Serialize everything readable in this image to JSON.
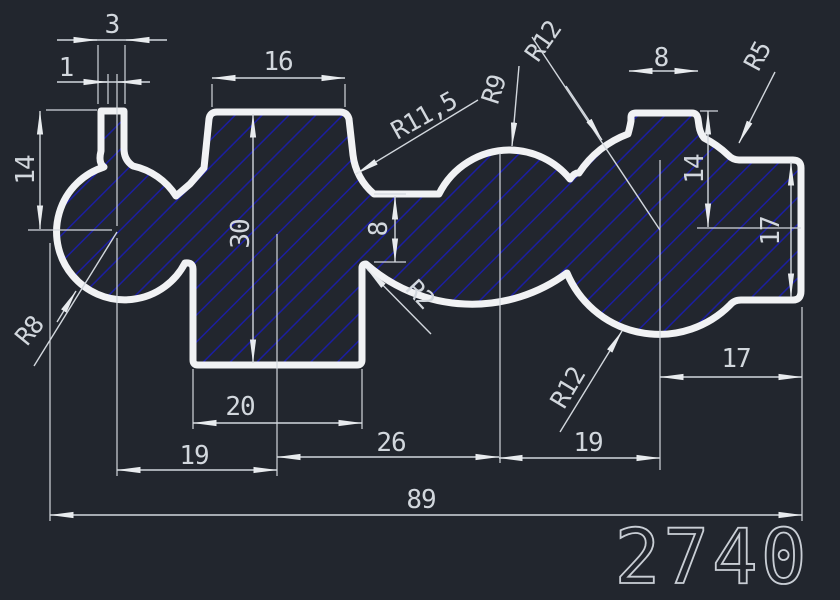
{
  "drawing": {
    "type": "cad-profile-drawing",
    "part_number": "2740",
    "colors": {
      "background": "#22262e",
      "hatch_blue": "#1b1ea0",
      "outline_white": "#f1f2f4",
      "dimension_gray": "#d2d7dd"
    },
    "dims": {
      "d3": "3",
      "d1": "1",
      "d16": "16",
      "d8_top": "8",
      "d14_left": "14",
      "d30": "30",
      "d8_mid": "8",
      "d14_right": "14",
      "d17_right": "17",
      "d20": "20",
      "d19_left": "19",
      "d26": "26",
      "d19_right": "19",
      "d17_bottom": "17",
      "d89": "89"
    },
    "radii": {
      "r8": "R8",
      "r11_5": "R11,5",
      "r9": "R9",
      "r12_top": "R12",
      "r5": "R5",
      "r2": "R2",
      "r12_bottom": "R12"
    }
  }
}
